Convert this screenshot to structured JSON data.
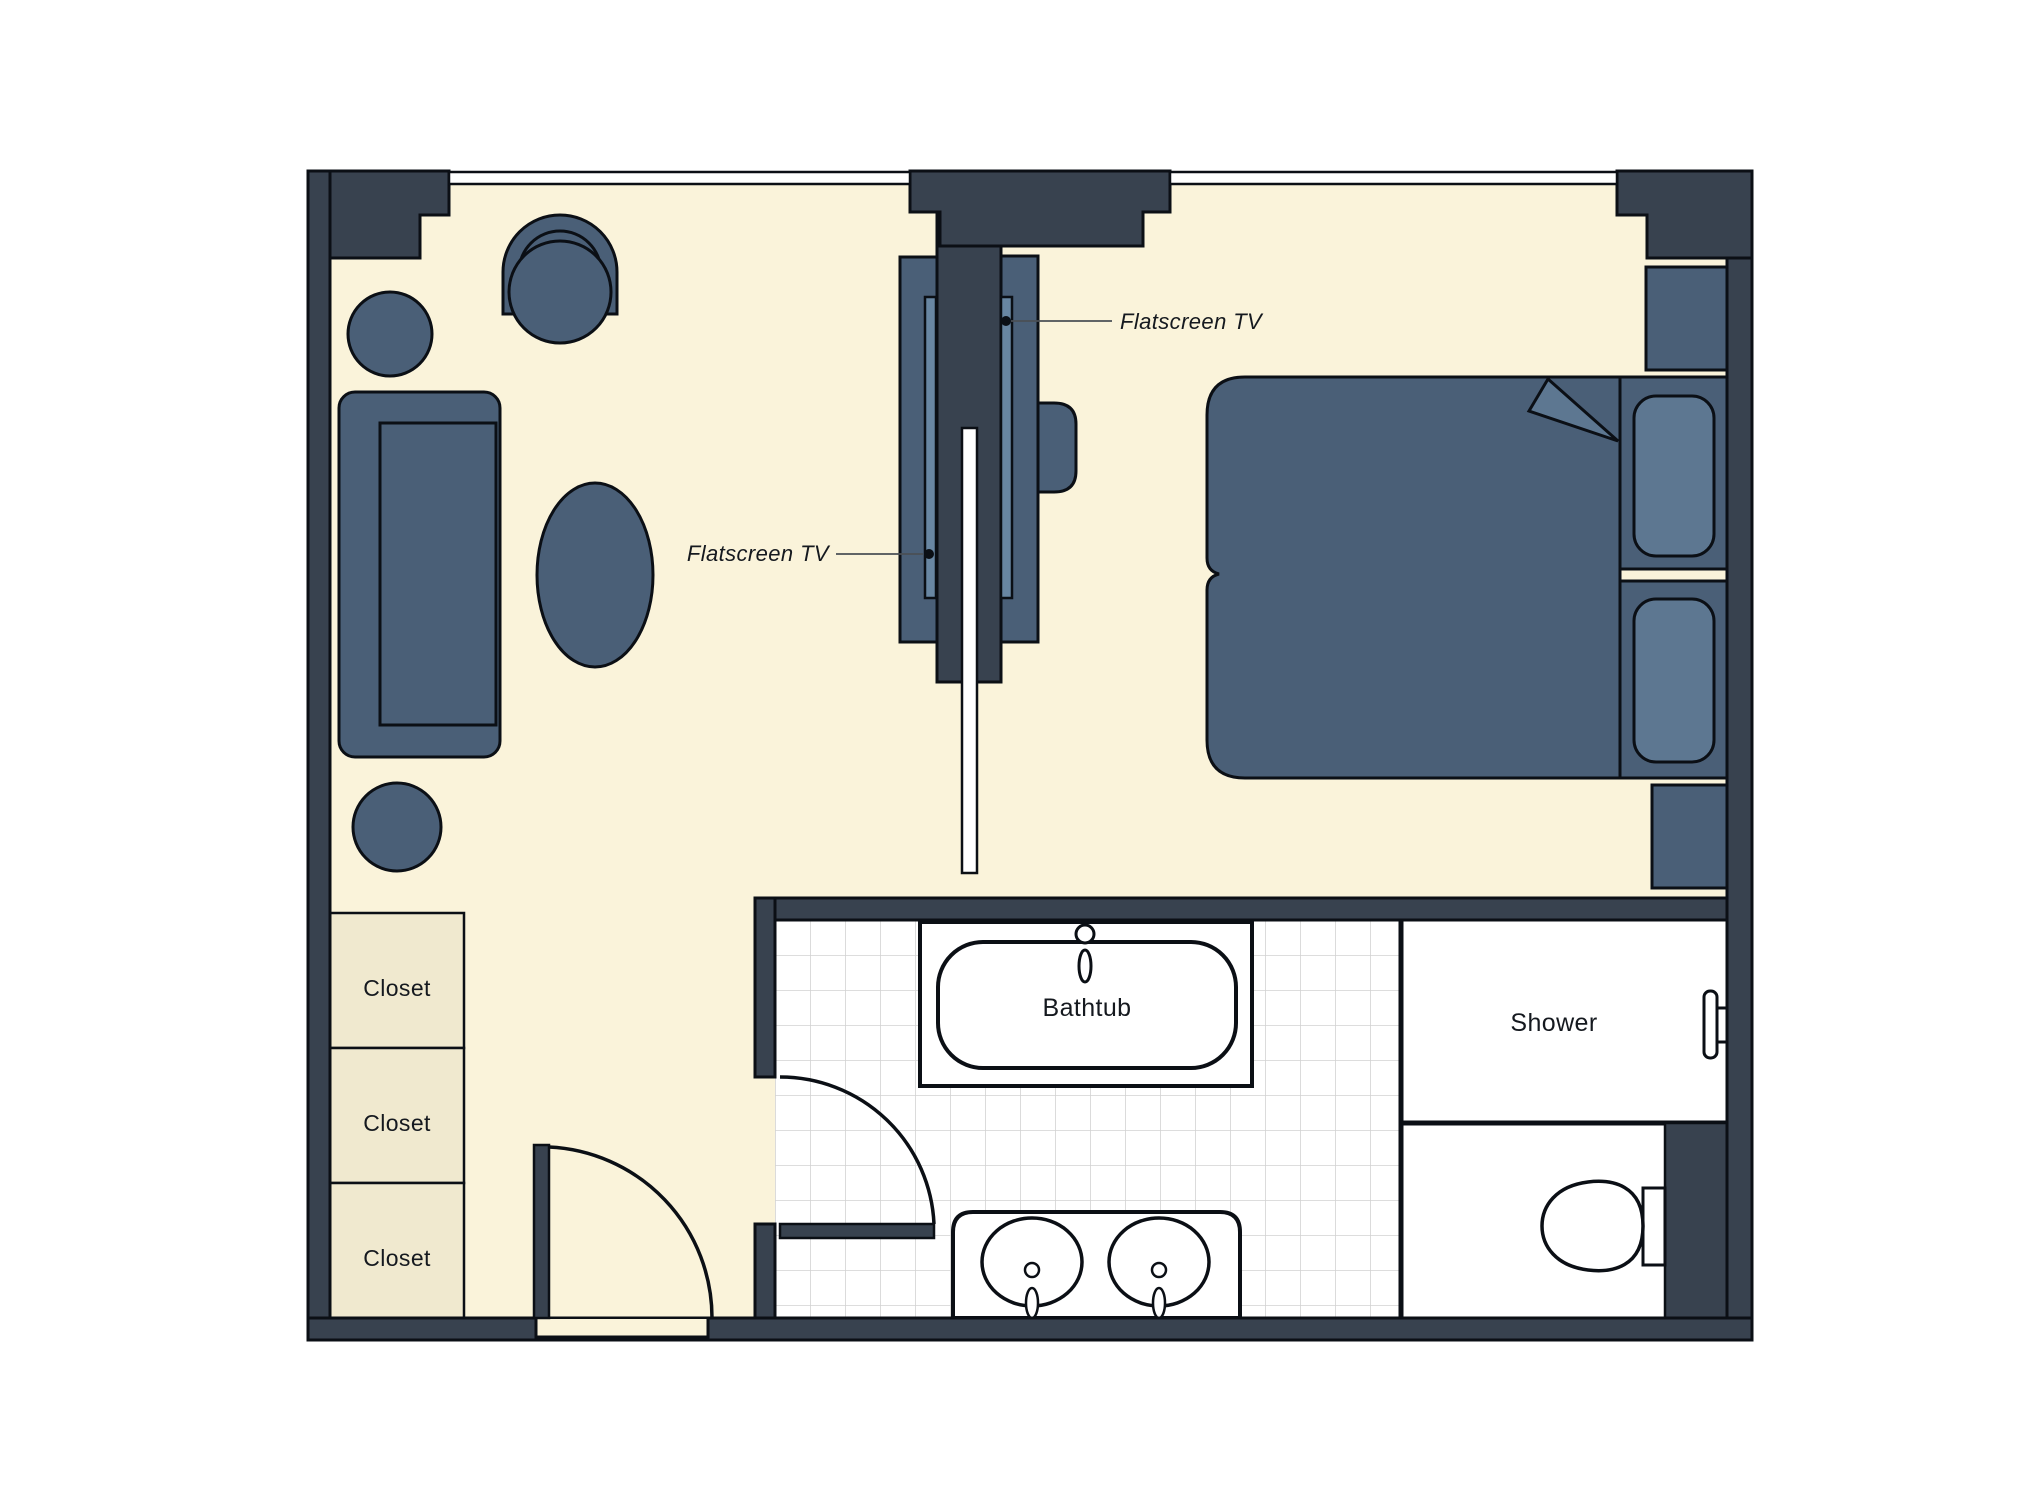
{
  "plan": {
    "type": "hotel-room-floor-plan",
    "labels": {
      "tv_living": "Flatscreen TV",
      "tv_bedroom": "Flatscreen TV",
      "bathtub": "Bathtub",
      "shower": "Shower",
      "closets": [
        "Closet",
        "Closet",
        "Closet"
      ]
    },
    "palette": {
      "wall": "#38424f",
      "outline": "#0b0f15",
      "floor": "#faf3da",
      "closet_fill": "#f0e9cf",
      "furniture": "#4a5f77",
      "furniture_light": "#5d7791",
      "tv_screen": "#6886a2",
      "fixture_white": "#ffffff",
      "tile_line": "#d2d2d2",
      "leader_line": "#4a4f55",
      "text": "#15191f",
      "background": "#ffffff"
    }
  }
}
